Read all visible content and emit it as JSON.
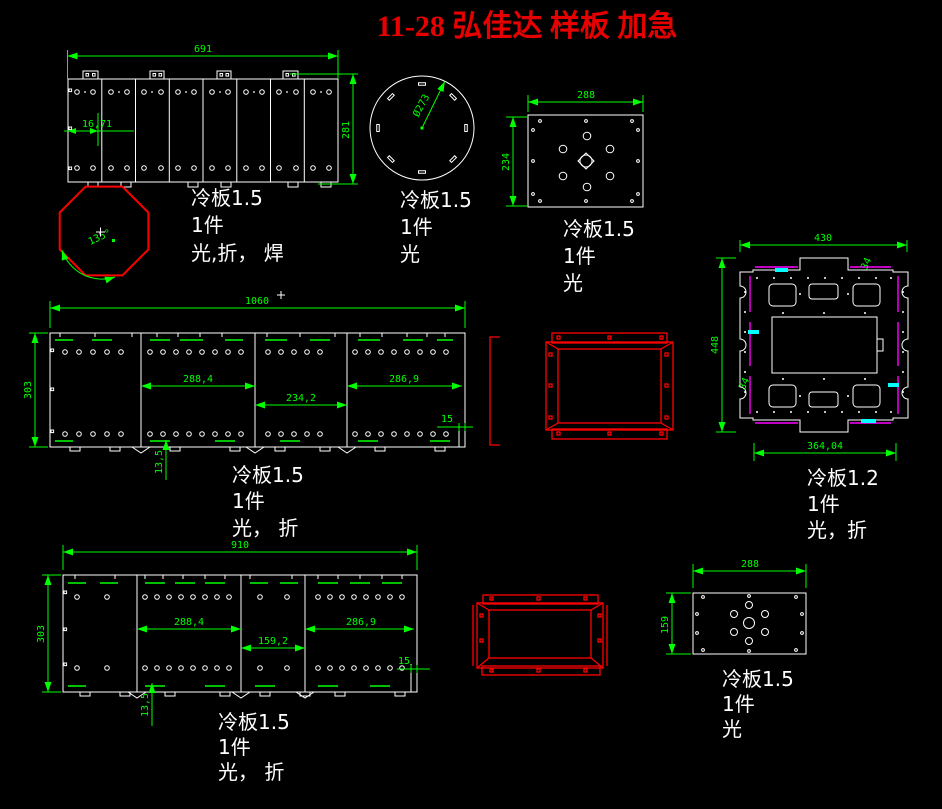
{
  "title": "11-28 弘佳达 样板 加急",
  "colors": {
    "background": "#000000",
    "dimension_green": "#00ff00",
    "outline_white": "#ffffff",
    "highlight_red": "#ff0000",
    "fold_magenta": "#ff00ff",
    "mark_cyan": "#00ffff"
  },
  "parts": {
    "panel691": {
      "dim_width": "691",
      "dim_height": "281",
      "dim_offset": "16,71",
      "label": [
        "冷板1.5",
        "1件",
        "光,折， 焊"
      ]
    },
    "octagon": {
      "dim_angle": "135°"
    },
    "disc": {
      "dim_diameter": "Ø273",
      "label": [
        "冷板1.5",
        "1件",
        "光"
      ]
    },
    "plate288x234": {
      "dim_width": "288",
      "dim_height": "234",
      "label": [
        "冷板1.5",
        "1件",
        "光"
      ]
    },
    "bracket430": {
      "dim_width": "430",
      "dim_height": "448",
      "dim_bottom": "364,04",
      "note_top": "34",
      "note_bottom": "34",
      "label": [
        "冷板1.2",
        "1件",
        "光，折"
      ]
    },
    "tray1060": {
      "dim_width": "1060",
      "dim_height": "303",
      "dim_seg1": "288,4",
      "dim_seg2": "234,2",
      "dim_seg3": "286,9",
      "dim_edge": "15",
      "dim_tab": "13,5",
      "label": [
        "冷板1.5",
        "1件",
        "光， 折"
      ]
    },
    "tray910": {
      "dim_width": "910",
      "dim_height": "303",
      "dim_seg1": "288,4",
      "dim_seg2": "159,2",
      "dim_seg3": "286,9",
      "dim_edge": "15",
      "dim_tab": "13,5",
      "label": [
        "冷板1.5",
        "1件",
        "光， 折"
      ]
    },
    "plate288x159": {
      "dim_width": "288",
      "dim_height": "159",
      "label": [
        "冷板1.5",
        "1件",
        "光"
      ]
    }
  }
}
